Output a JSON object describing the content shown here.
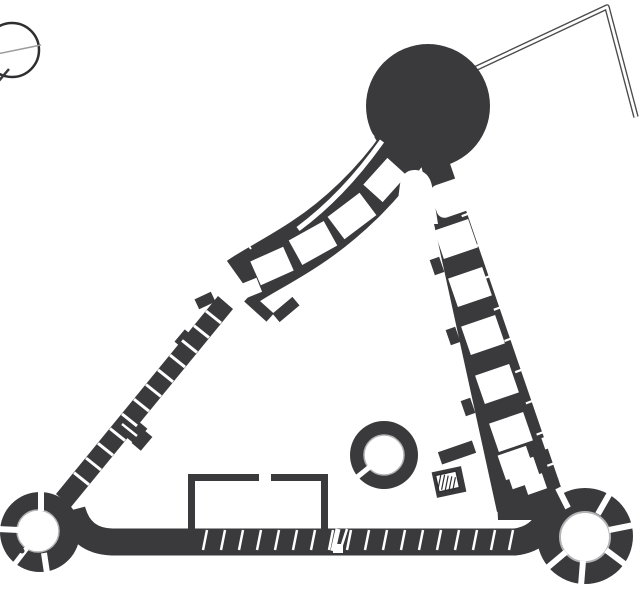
{
  "canvas": {
    "width": 643,
    "height": 591
  },
  "palette": {
    "background": "#ffffff",
    "dark": "#3a3a3c",
    "white": "#ffffff",
    "light": "#b3b3b5",
    "line": "#2f2f31",
    "outline": "#4b4b4d",
    "faint": "#9c9c9e"
  },
  "figure": {
    "kind": "architectural-floor-plan",
    "elements": [
      "compass-rose",
      "round-keep",
      "north-range",
      "east-range",
      "west-curtain-wall",
      "south-casemate-wall",
      "southwest-ring-tower",
      "southeast-ring-tower",
      "well-tower",
      "courtyard-building-outline",
      "annex-wall-outline",
      "staircase"
    ]
  },
  "shapes": [
    {
      "name": "compass-circle",
      "t": "circle",
      "cx": 12,
      "cy": 50,
      "r": 27,
      "s": "line",
      "sw": 2.5
    },
    {
      "name": "compass-cross-line",
      "t": "line",
      "x1": -18,
      "y1": 57,
      "x2": 41,
      "y2": 45,
      "s": "faint",
      "sw": 1.5
    },
    {
      "name": "compass-needle",
      "t": "line",
      "x1": 9,
      "y1": 69,
      "x2": -14,
      "y2": 96,
      "s": "dark",
      "sw": 2.5
    },
    {
      "name": "annex-wall-outline",
      "t": "path",
      "d": "M 466,73 L 607,7 L 636,117",
      "s": "outline",
      "sw": 5.5
    },
    {
      "name": "annex-wall-core",
      "t": "path",
      "d": "M 466,73 L 607,7 L 636,117",
      "s": "white",
      "sw": 2.8
    },
    {
      "name": "keep-tower",
      "t": "circle",
      "cx": 428,
      "cy": 106,
      "r": 62,
      "f": "dark"
    },
    {
      "name": "north-range",
      "t": "path",
      "d": "M 404,147 C 377,186 341,220 306,243 C 279,261 256,272 242,282",
      "s": "dark",
      "sw": 52,
      "cap": "butt"
    },
    {
      "name": "east-range",
      "t": "poly",
      "pts": "446,152 562,490 497,512 420,160",
      "f": "dark"
    },
    {
      "name": "west-curtain-wall",
      "t": "poly",
      "pts": "218,296 233,309 71,507 56,494",
      "f": "dark"
    },
    {
      "name": "southeast-junction",
      "t": "poly",
      "pts": "495,455 558,478 568,520 498,520",
      "f": "dark"
    },
    {
      "name": "range-end-wall-a",
      "t": "rect",
      "x": 244,
      "y": 302,
      "w": 30,
      "h": 11,
      "rot": 42,
      "f": "dark"
    },
    {
      "name": "range-end-wall-b",
      "t": "rect",
      "x": 273,
      "y": 304,
      "w": 26,
      "h": 11,
      "rot": -40,
      "f": "dark"
    },
    {
      "name": "gate-pier",
      "t": "rect",
      "x": 196,
      "y": 295,
      "w": 18,
      "h": 11,
      "rot": -25,
      "f": "dark"
    },
    {
      "name": "wall-buttress",
      "t": "rect",
      "x": 177,
      "y": 333,
      "w": 16,
      "h": 14,
      "rot": -50,
      "f": "dark"
    },
    {
      "name": "wall-turret-a",
      "t": "rect",
      "x": 121,
      "y": 415,
      "w": 20,
      "h": 26,
      "rot": -50,
      "f": "dark"
    },
    {
      "name": "wall-turret-b",
      "t": "rect",
      "x": 133,
      "y": 434,
      "w": 18,
      "h": 12,
      "rot": -50,
      "f": "dark"
    },
    {
      "name": "south-wall",
      "t": "path",
      "d": "M 72,510 Q 80,541 112,542 L 515,542 Q 540,539 550,516",
      "s": "dark",
      "sw": 27
    },
    {
      "name": "southwest-tower-ring",
      "t": "circle",
      "cx": 40,
      "cy": 532,
      "r": 40,
      "f": "dark"
    },
    {
      "name": "southwest-tower-court",
      "t": "circle",
      "cx": 38,
      "cy": 531,
      "r": 21,
      "f": "white",
      "s": "light",
      "sw": 1.5
    },
    {
      "name": "southeast-tower-ring",
      "t": "circle",
      "cx": 585,
      "cy": 536,
      "r": 48,
      "f": "dark"
    },
    {
      "name": "southeast-tower-court",
      "t": "circle",
      "cx": 585,
      "cy": 537,
      "r": 25,
      "f": "white",
      "s": "light",
      "sw": 2
    },
    {
      "name": "courtyard-apex",
      "t": "path",
      "d": "M 395,224 L 400,184 Q 403,169 416,170 Q 429,171 432,186 L 438,224 Z",
      "f": "white"
    },
    {
      "name": "north-corridor",
      "t": "path",
      "d": "M 382,141 C 358,175 329,206 298,229",
      "s": "white",
      "sw": 5
    },
    {
      "name": "room",
      "t": "rect",
      "x": 367,
      "y": 167,
      "w": 36,
      "h": 26,
      "rot": -48,
      "f": "white"
    },
    {
      "name": "room",
      "t": "rect",
      "x": 332,
      "y": 202,
      "w": 40,
      "h": 28,
      "rot": -37,
      "f": "white"
    },
    {
      "name": "room",
      "t": "rect",
      "x": 293,
      "y": 229,
      "w": 40,
      "h": 28,
      "rot": -29,
      "f": "white"
    },
    {
      "name": "room",
      "t": "rect",
      "x": 254,
      "y": 253,
      "w": 36,
      "h": 26,
      "rot": -24,
      "f": "white"
    },
    {
      "name": "room",
      "t": "rect",
      "x": 240,
      "y": 281,
      "w": 20,
      "h": 15,
      "rot": -22,
      "f": "white"
    },
    {
      "name": "range-tick",
      "t": "line",
      "x1": 369,
      "y1": 131,
      "x2": 374,
      "y2": 137,
      "s": "white",
      "sw": 2
    },
    {
      "name": "range-tick",
      "t": "line",
      "x1": 348,
      "y1": 155,
      "x2": 353,
      "y2": 161,
      "s": "white",
      "sw": 2
    },
    {
      "name": "range-tick",
      "t": "line",
      "x1": 325,
      "y1": 180,
      "x2": 330,
      "y2": 186,
      "s": "white",
      "sw": 2
    },
    {
      "name": "range-tick",
      "t": "line",
      "x1": 299,
      "y1": 203,
      "x2": 304,
      "y2": 209,
      "s": "white",
      "sw": 2
    },
    {
      "name": "range-tick",
      "t": "line",
      "x1": 272,
      "y1": 224,
      "x2": 277,
      "y2": 230,
      "s": "white",
      "sw": 2
    },
    {
      "name": "range-tick",
      "t": "line",
      "x1": 247,
      "y1": 243,
      "x2": 251,
      "y2": 249,
      "s": "white",
      "sw": 2
    },
    {
      "name": "range-end-slit",
      "t": "line",
      "x1": 247,
      "y1": 293,
      "x2": 241,
      "y2": 300,
      "s": "white",
      "sw": 2
    },
    {
      "name": "west-wall-slits",
      "t": "rep",
      "x1": 206,
      "y1": 311,
      "x2": 221,
      "y2": 323,
      "dx": -12,
      "dy": 14.7,
      "n": 12,
      "s": "white",
      "sw": 3
    },
    {
      "name": "turret-slit",
      "t": "line",
      "x1": 122,
      "y1": 424,
      "x2": 137,
      "y2": 436,
      "s": "white",
      "sw": 2.5
    },
    {
      "name": "room",
      "t": "rect",
      "x": 433,
      "y": 181,
      "w": 36,
      "h": 34,
      "rx": 8,
      "rot": -19,
      "f": "white"
    },
    {
      "name": "room",
      "t": "rect",
      "x": 438,
      "y": 224,
      "w": 36,
      "h": 30,
      "rot": -19,
      "f": "white"
    },
    {
      "name": "room",
      "t": "rect",
      "x": 452,
      "y": 272,
      "w": 36,
      "h": 30,
      "rot": -19,
      "f": "white"
    },
    {
      "name": "room",
      "t": "rect",
      "x": 465,
      "y": 320,
      "w": 36,
      "h": 30,
      "rot": -19,
      "f": "white"
    },
    {
      "name": "room",
      "t": "rect",
      "x": 479,
      "y": 369,
      "w": 36,
      "h": 30,
      "rot": -19,
      "f": "white"
    },
    {
      "name": "room",
      "t": "rect",
      "x": 493,
      "y": 417,
      "w": 36,
      "h": 30,
      "rot": -19,
      "f": "white"
    },
    {
      "name": "room",
      "t": "rect",
      "x": 508,
      "y": 461,
      "w": 30,
      "h": 24,
      "rot": -19,
      "f": "white"
    },
    {
      "name": "east-range-ticks",
      "t": "rep",
      "x1": 459,
      "y1": 182,
      "x2": 451,
      "y2": 185,
      "dx": 10.7,
      "dy": 31.2,
      "n": 10,
      "s": "white",
      "sw": 2.2
    },
    {
      "name": "courtyard-nub",
      "t": "rect",
      "x": 432,
      "y": 258,
      "w": 10,
      "h": 16,
      "rot": -19,
      "f": "dark"
    },
    {
      "name": "courtyard-nub",
      "t": "rect",
      "x": 448,
      "y": 328,
      "w": 10,
      "h": 16,
      "rot": -19,
      "f": "dark"
    },
    {
      "name": "courtyard-nub",
      "t": "rect",
      "x": 463,
      "y": 399,
      "w": 10,
      "h": 16,
      "rot": -19,
      "f": "dark"
    },
    {
      "name": "stair-wall",
      "t": "rect",
      "x": 439,
      "y": 446,
      "w": 36,
      "h": 13,
      "rot": -19,
      "f": "dark"
    },
    {
      "name": "stair-block",
      "t": "rect",
      "x": 434,
      "y": 469,
      "w": 30,
      "h": 26,
      "rot": -12,
      "f": "dark"
    },
    {
      "name": "staircase",
      "t": "rect",
      "x": 437,
      "y": 473,
      "w": 21,
      "h": 17,
      "rot": -12,
      "f": "white",
      "s": "line",
      "sw": 1.5
    },
    {
      "name": "stair-hatch",
      "t": "rep",
      "x1": 441,
      "y1": 474,
      "x2": 438,
      "y2": 489,
      "dx": 3.6,
      "dy": 0.8,
      "n": 5,
      "s": "line",
      "sw": 1.2
    },
    {
      "name": "room",
      "t": "rect",
      "x": 501,
      "y": 450,
      "w": 30,
      "h": 26,
      "rot": -19,
      "f": "white"
    },
    {
      "name": "room",
      "t": "rect",
      "x": 525,
      "y": 476,
      "w": 20,
      "h": 16,
      "rot": -19,
      "f": "white"
    },
    {
      "name": "wall-window",
      "t": "rect",
      "x": 543,
      "y": 436,
      "w": 11,
      "h": 12,
      "rot": -19,
      "f": "white"
    },
    {
      "name": "range-foot-gap",
      "t": "line",
      "x1": 456,
      "y1": 516,
      "x2": 492,
      "y2": 505,
      "s": "white",
      "sw": 4
    },
    {
      "name": "tower-joint-gap",
      "t": "line",
      "x1": 568,
      "y1": 508,
      "x2": 558,
      "y2": 488,
      "s": "white",
      "sw": 6
    },
    {
      "name": "south-wall-slits",
      "t": "rep",
      "x1": 207,
      "y1": 530,
      "x2": 203,
      "y2": 550,
      "dx": 18,
      "dy": 0,
      "n": 18,
      "s": "white",
      "sw": 2.5
    },
    {
      "name": "south-gate-slit",
      "t": "line",
      "x1": 338,
      "y1": 529,
      "x2": 333,
      "y2": 551,
      "s": "white",
      "sw": 5
    },
    {
      "name": "south-gate-slit-b",
      "t": "line",
      "x1": 347,
      "y1": 529,
      "x2": 340,
      "y2": 551,
      "s": "white",
      "sw": 2.5
    },
    {
      "name": "south-gate-notch",
      "t": "rect",
      "x": 333,
      "y": 544,
      "w": 10,
      "h": 9,
      "f": "white"
    },
    {
      "name": "tower-slit",
      "t": "line",
      "x1": 41,
      "y1": 511,
      "x2": 41,
      "y2": 490,
      "s": "white",
      "sw": 6
    },
    {
      "name": "tower-slit",
      "t": "line",
      "x1": 19,
      "y1": 530,
      "x2": -2,
      "y2": 529,
      "s": "white",
      "sw": 6
    },
    {
      "name": "tower-slit",
      "t": "line",
      "x1": 27,
      "y1": 548,
      "x2": 14,
      "y2": 565,
      "s": "white",
      "sw": 5
    },
    {
      "name": "tower-slit",
      "t": "line",
      "x1": 44,
      "y1": 553,
      "x2": 47,
      "y2": 573,
      "s": "white",
      "sw": 6
    },
    {
      "name": "tower-door-dot",
      "t": "circle",
      "cx": 22,
      "cy": 551,
      "r": 2.5,
      "f": "dark"
    },
    {
      "name": "tower-slit",
      "t": "line",
      "x1": 598,
      "y1": 514,
      "x2": 610,
      "y2": 493,
      "s": "white",
      "sw": 6
    },
    {
      "name": "tower-slit",
      "t": "line",
      "x1": 609,
      "y1": 530,
      "x2": 634,
      "y2": 525,
      "s": "white",
      "sw": 6
    },
    {
      "name": "tower-slit",
      "t": "line",
      "x1": 606,
      "y1": 550,
      "x2": 626,
      "y2": 565,
      "s": "white",
      "sw": 6
    },
    {
      "name": "tower-slit",
      "t": "line",
      "x1": 583,
      "y1": 561,
      "x2": 581,
      "y2": 586,
      "s": "white",
      "sw": 6
    },
    {
      "name": "tower-slit",
      "t": "line",
      "x1": 566,
      "y1": 552,
      "x2": 547,
      "y2": 568,
      "s": "white",
      "sw": 6
    },
    {
      "name": "well-tower-ring",
      "t": "circle",
      "cx": 384,
      "cy": 455,
      "r": 34,
      "f": "dark"
    },
    {
      "name": "well-tower-court",
      "t": "circle",
      "cx": 384,
      "cy": 455,
      "r": 20,
      "f": "white",
      "s": "light",
      "sw": 1.5
    },
    {
      "name": "well-tower-door",
      "t": "line",
      "x1": 371,
      "y1": 466,
      "x2": 356,
      "y2": 478,
      "s": "white",
      "sw": 5
    },
    {
      "name": "door-jamb",
      "t": "rect",
      "x": 365,
      "y": 474,
      "w": 4,
      "h": 4,
      "f": "dark"
    },
    {
      "name": "door-jamb",
      "t": "rect",
      "x": 358,
      "y": 466,
      "w": 4,
      "h": 4,
      "f": "dark"
    },
    {
      "name": "courtyard-building-wall",
      "t": "rect",
      "x": 188,
      "y": 474,
      "w": 7,
      "h": 58,
      "f": "dark"
    },
    {
      "name": "courtyard-building-wall",
      "t": "rect",
      "x": 188,
      "y": 474,
      "w": 71,
      "h": 7,
      "f": "dark"
    },
    {
      "name": "courtyard-building-wall",
      "t": "rect",
      "x": 271,
      "y": 474,
      "w": 57,
      "h": 7,
      "f": "dark"
    },
    {
      "name": "courtyard-building-wall",
      "t": "rect",
      "x": 321,
      "y": 474,
      "w": 7,
      "h": 58,
      "f": "dark"
    }
  ]
}
